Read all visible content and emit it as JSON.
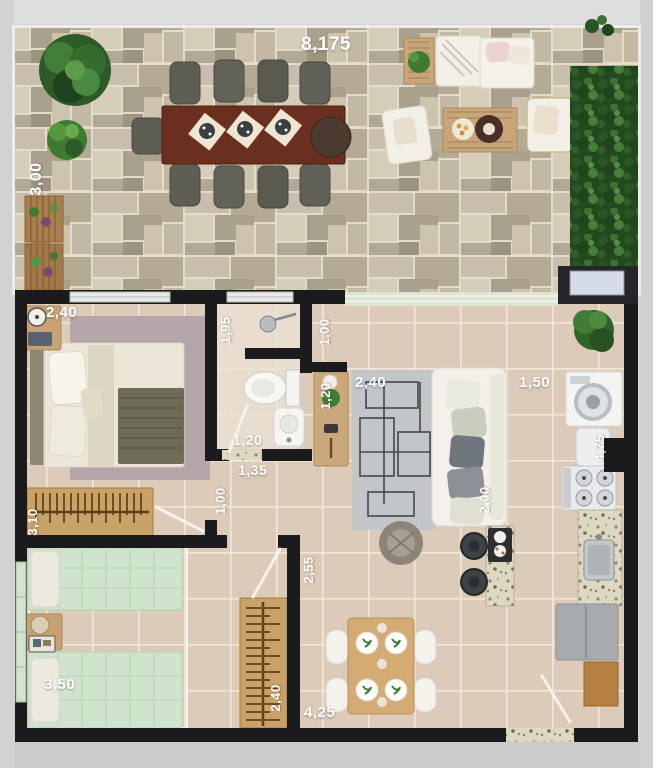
{
  "title": "apartment-floor-plan",
  "dimensions": {
    "terrace_width": "8,175",
    "terrace_depth": "3,00",
    "bedroom1_width": "2,40",
    "bathroom_depth": "1,95",
    "nook_width": "1,00",
    "console_length": "1,20",
    "living_rug_width": "2,40",
    "kitchen_width": "1,50",
    "kitchen_length": "4,75",
    "bathroom_width": "1,20",
    "hall_width": "1,35",
    "hall_length": "1,00",
    "bedroom1_length": "3,10",
    "sofa_length": "2,00",
    "dining_length": "2,55",
    "bedroom2_width": "3,50",
    "closet_length": "2,40",
    "dining_width": "4,25"
  },
  "colors": {
    "wall": "#1b1b1d",
    "floor_tile": "#ddcbb9",
    "terrace_stone": "#c3b9a5",
    "hedge_green": "#2a5526",
    "wood": "#c9a267",
    "dimension_text": "#ffffff"
  }
}
